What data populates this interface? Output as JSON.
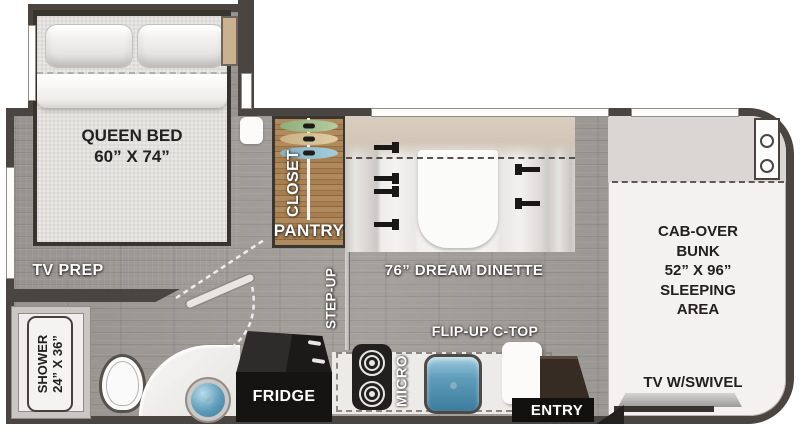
{
  "title": "RV floor plan",
  "colors": {
    "wall": "#4b4541",
    "floor": "#a09c98",
    "closet_wood": "#a87f51",
    "sink_blue": "#5e9cba",
    "hanger_green": "#a3bd8d",
    "hanger_tan": "#d6c193",
    "hanger_blue": "#92bac8"
  },
  "rooms": {
    "bedroom": {
      "bed_line1": "QUEEN BED",
      "bed_line2": "60” X 74”",
      "tv_prep": "TV PREP"
    },
    "bathroom": {
      "shower_line1": "SHOWER",
      "shower_line2": "24” X 36”"
    },
    "storage": {
      "closet": "CLOSET",
      "pantry": "PANTRY"
    },
    "kitchen": {
      "step_up": "STEP-UP",
      "fridge": "FRIDGE",
      "micro": "MICRO",
      "flip_up": "FLIP-UP C-TOP",
      "entry": "ENTRY"
    },
    "dinette": {
      "label": "76” DREAM DINETTE"
    },
    "cab": {
      "lines": [
        "CAB-OVER",
        "BUNK",
        "52” X 96”",
        "SLEEPING",
        "AREA"
      ],
      "tv": "TV W/SWIVEL"
    }
  }
}
